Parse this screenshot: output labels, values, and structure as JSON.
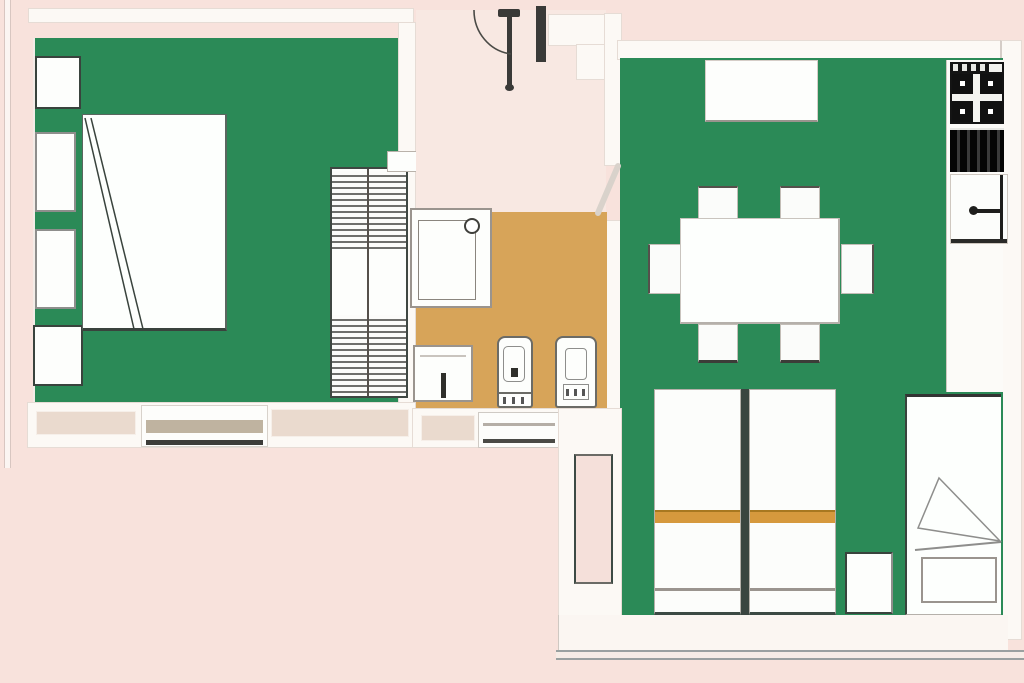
{
  "palette": {
    "background": "#f8e2dc",
    "floor_green": "#2b8a57",
    "floor_tan": "#d7a459",
    "floor_hall": "#f8e8e2",
    "wall": "#fcf9f5",
    "outline_dark": "#39433d",
    "outline_gray": "#8e8e8c",
    "blanket_orange": "#d6993d",
    "appliance_black": "#141414"
  },
  "rooms": [
    {
      "id": "bedroom",
      "floor": "green",
      "furniture": [
        "double-bed",
        "nightstand",
        "cabinet",
        "cabinet",
        "nightstand",
        "shelved-closet",
        "door",
        "window"
      ]
    },
    {
      "id": "entrance-hall",
      "floor": "pink",
      "furniture": [
        "entry-door-with-swing-arc",
        "door-to-living-room"
      ]
    },
    {
      "id": "bathroom",
      "floor": "tan",
      "furniture": [
        "shower",
        "washbasin",
        "toilet",
        "bidet",
        "window"
      ]
    },
    {
      "id": "living-room",
      "floor": "green",
      "furniture": [
        "sideboard",
        "dining-table",
        "chair",
        "chair",
        "chair",
        "chair",
        "chair",
        "chair",
        "single-bed",
        "single-bed",
        "single-bed",
        "nightstand",
        "balcony-window"
      ]
    },
    {
      "id": "kitchen-corner",
      "floor": "green",
      "furniture": [
        "cooktop",
        "oven",
        "kitchen-sink",
        "counter"
      ]
    },
    {
      "id": "balcony",
      "floor": "white",
      "furniture": [
        "railing"
      ]
    }
  ]
}
